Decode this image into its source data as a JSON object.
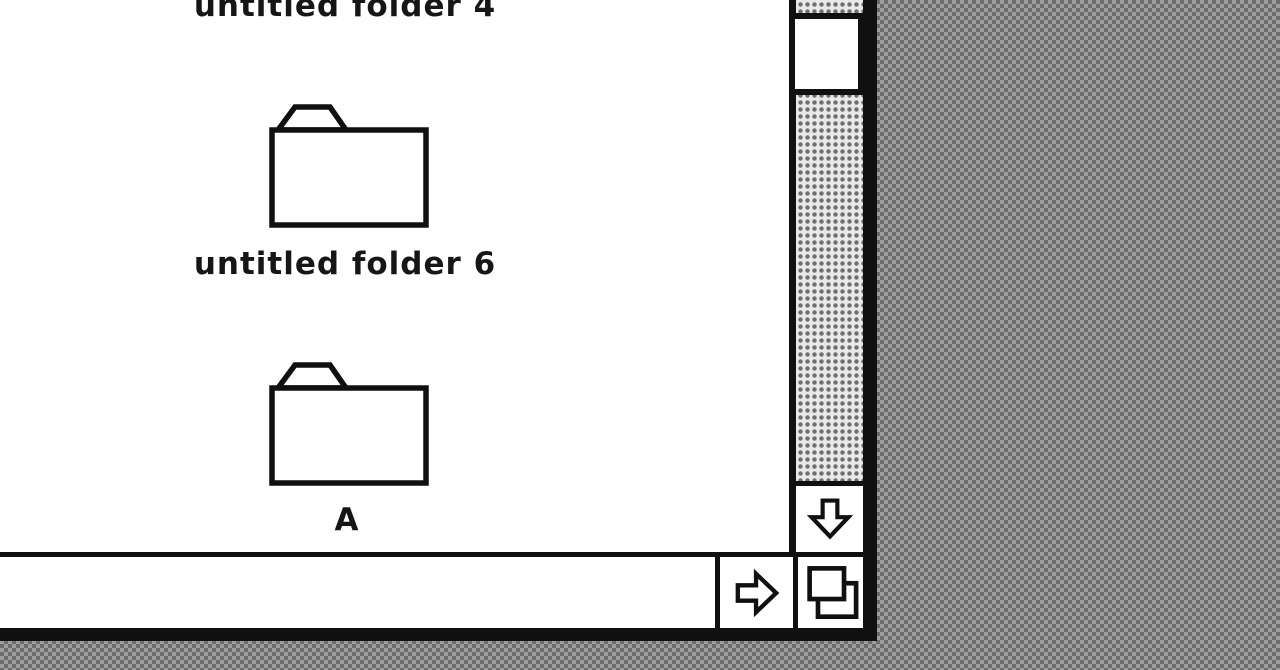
{
  "colors": {
    "window_bg": "#ffffff",
    "border_black": "#101010",
    "desktop_dark": "#6c6c6c",
    "desktop_light": "#9e9e9e",
    "track_bg": "#e9e9e9",
    "track_dot": "#6f6f6f",
    "text": "#161616"
  },
  "desktop": {
    "pattern": "50% gray dither"
  },
  "window": {
    "view": "icon view",
    "items": [
      {
        "label": "untitled folder 4",
        "kind": "folder"
      },
      {
        "label": "untitled folder 6",
        "kind": "folder"
      },
      {
        "label": "A",
        "kind": "folder"
      }
    ],
    "icons": {
      "folder": "folder-outline 🗀",
      "down_arrow": "▽",
      "right_arrow": "▷",
      "grow_box": "❐ overlapping-squares"
    },
    "scrollbars": {
      "vertical": {
        "state": "active",
        "track": "dotted-gray-dither",
        "thumb": "white box near top"
      },
      "horizontal": {
        "state": "inactive",
        "track": "plain-white"
      }
    }
  }
}
